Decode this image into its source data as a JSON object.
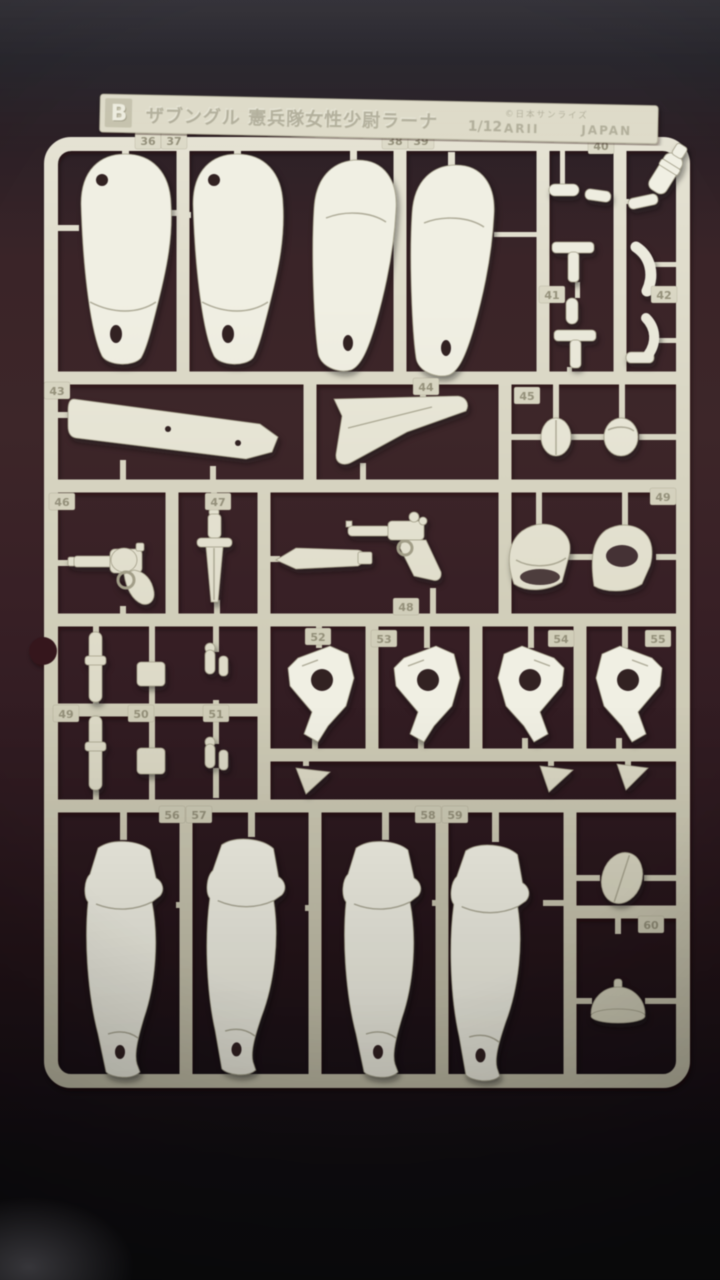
{
  "scene": {
    "type": "photograph",
    "subject": "Plastic model kit parts sprue (runner B) photographed on a dark surface",
    "colors": {
      "plastic_light": "#f0efe3",
      "plastic_base": "#d8d5c2",
      "plastic_shadow": "#b3ae98",
      "tag_digits": "#8e8a74",
      "background_top": "#232128",
      "background_mid": "#3b2428",
      "background_bottom": "#121014"
    }
  },
  "label": {
    "runner_letter": "B",
    "title": "ザブングル 憲兵隊女性少尉ラーナ",
    "scale": "1/12",
    "copyright": "©日本サンライズ",
    "maker": "ARII",
    "origin": "JAPAN"
  },
  "parts": {
    "tags": [
      {
        "n": "36",
        "x": 148,
        "y": 141
      },
      {
        "n": "37",
        "x": 174,
        "y": 141
      },
      {
        "n": "38",
        "x": 395,
        "y": 141
      },
      {
        "n": "39",
        "x": 421,
        "y": 141
      },
      {
        "n": "40",
        "x": 601,
        "y": 146
      },
      {
        "n": "41",
        "x": 552,
        "y": 295
      },
      {
        "n": "42",
        "x": 664,
        "y": 295
      },
      {
        "n": "43",
        "x": 57,
        "y": 391
      },
      {
        "n": "44",
        "x": 426,
        "y": 387
      },
      {
        "n": "45",
        "x": 527,
        "y": 396
      },
      {
        "n": "46",
        "x": 62,
        "y": 502
      },
      {
        "n": "47",
        "x": 218,
        "y": 502
      },
      {
        "n": "48",
        "x": 406,
        "y": 607
      },
      {
        "n": "49",
        "x": 663,
        "y": 497
      },
      {
        "n": "49",
        "x": 66,
        "y": 714
      },
      {
        "n": "50",
        "x": 141,
        "y": 714
      },
      {
        "n": "51",
        "x": 216,
        "y": 714
      },
      {
        "n": "52",
        "x": 318,
        "y": 637
      },
      {
        "n": "53",
        "x": 384,
        "y": 639
      },
      {
        "n": "54",
        "x": 561,
        "y": 639
      },
      {
        "n": "55",
        "x": 658,
        "y": 639
      },
      {
        "n": "56",
        "x": 172,
        "y": 815
      },
      {
        "n": "57",
        "x": 199,
        "y": 815
      },
      {
        "n": "58",
        "x": 428,
        "y": 815
      },
      {
        "n": "59",
        "x": 455,
        "y": 815
      },
      {
        "n": "60",
        "x": 651,
        "y": 925
      }
    ]
  }
}
